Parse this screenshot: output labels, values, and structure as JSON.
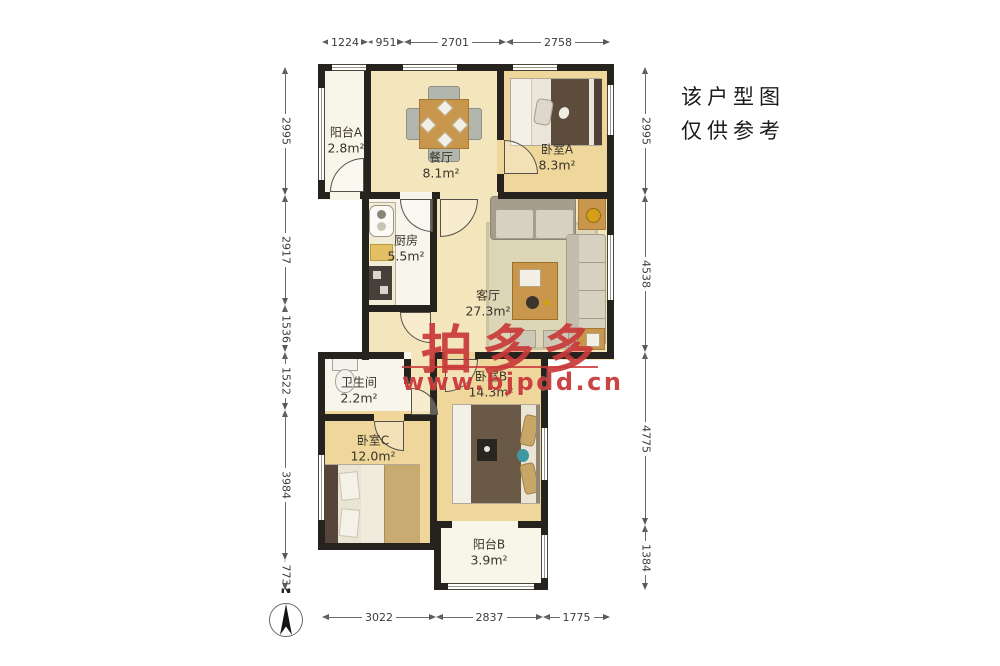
{
  "note": {
    "line1": "该户型图",
    "line2": "仅供参考"
  },
  "watermark": {
    "brand": "拍多多",
    "url": "www.bjpdd.cn",
    "color": "#c93a3a"
  },
  "compass": {
    "label": "N"
  },
  "rooms": [
    {
      "name": "阳台A",
      "area": "2.8m²"
    },
    {
      "name": "餐厅",
      "area": "8.1m²"
    },
    {
      "name": "卧室A",
      "area": "8.3m²"
    },
    {
      "name": "厨房",
      "area": "5.5m²"
    },
    {
      "name": "客厅",
      "area": "27.3m²"
    },
    {
      "name": "卫生间",
      "area": "2.2m²"
    },
    {
      "name": "卧室B",
      "area": "14.3m²"
    },
    {
      "name": "卧室C",
      "area": "12.0m²"
    },
    {
      "name": "阳台B",
      "area": "3.9m²"
    }
  ],
  "dimensions": {
    "top": {
      "y": 36,
      "segments": [
        {
          "label": "1224",
          "from": 322,
          "to": 368
        },
        {
          "label": "951",
          "from": 368,
          "to": 404
        },
        {
          "label": "2701",
          "from": 404,
          "to": 506
        },
        {
          "label": "2758",
          "from": 506,
          "to": 610
        }
      ]
    },
    "bottom": {
      "y": 611,
      "segments": [
        {
          "label": "3022",
          "from": 322,
          "to": 436
        },
        {
          "label": "2837",
          "from": 436,
          "to": 543
        },
        {
          "label": "1775",
          "from": 543,
          "to": 610
        }
      ]
    },
    "left": {
      "x": 279,
      "segments": [
        {
          "label": "2995",
          "from": 67,
          "to": 195
        },
        {
          "label": "2917",
          "from": 195,
          "to": 305
        },
        {
          "label": "1536",
          "from": 305,
          "to": 352
        },
        {
          "label": "1522",
          "from": 352,
          "to": 410
        },
        {
          "label": "3984",
          "from": 410,
          "to": 560
        },
        {
          "label": "773",
          "from": 560,
          "to": 590
        }
      ]
    },
    "right": {
      "x": 639,
      "segments": [
        {
          "label": "2995",
          "from": 67,
          "to": 195
        },
        {
          "label": "4538",
          "from": 195,
          "to": 352
        },
        {
          "label": "4775",
          "from": 352,
          "to": 525
        },
        {
          "label": "1384",
          "from": 525,
          "to": 590
        }
      ]
    }
  },
  "colors": {
    "wall": "#26231e",
    "floor_wood": "#efd79b",
    "floor_cream": "#f4e6bc",
    "floor_white": "#f8f5ec",
    "watermark_red": "#c93a3a"
  }
}
